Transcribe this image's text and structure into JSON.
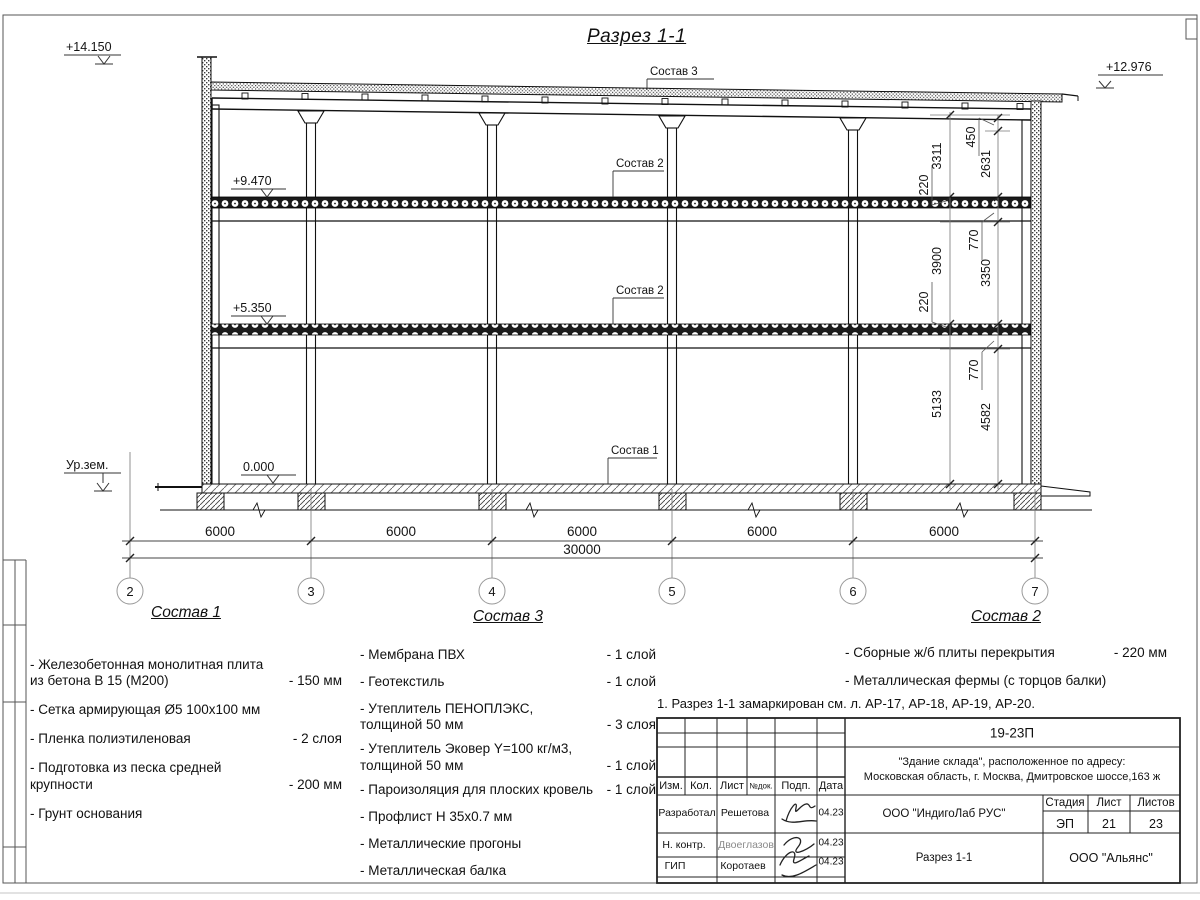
{
  "sheet": {
    "title": "Разрез 1-1",
    "note": "1. Разрез 1-1 замаркирован см. л. АР-17, АР-18, АР-19, АР-20."
  },
  "drawing": {
    "elevations": {
      "roof_left": "+14.150",
      "roof_right": "+12.976",
      "level2": "+9.470",
      "level1": "+5.350",
      "zero": "0.000",
      "ground": "Ур.зем."
    },
    "axes": [
      "2",
      "3",
      "4",
      "5",
      "6",
      "7"
    ],
    "spans": [
      "6000",
      "6000",
      "6000",
      "6000",
      "6000"
    ],
    "total": "30000",
    "vdims": {
      "d3311": "3311",
      "d3900": "3900",
      "d5133": "5133",
      "d2631": "2631",
      "d3350": "3350",
      "d4582": "4582",
      "d450": "450",
      "d770a": "770",
      "d770b": "770",
      "d220a": "220",
      "d220b": "220"
    },
    "labels": {
      "sostav3": "Состав 3",
      "sostav2a": "Состав 2",
      "sostav2b": "Состав 2",
      "sostav1": "Состав 1"
    }
  },
  "lists": {
    "sostav1": {
      "title": "Состав 1",
      "items": [
        {
          "name": "- Железобетонная  монолитная плита из бетона В 15 (М200)",
          "value": "- 150 мм"
        },
        {
          "name": "- Сетка армирующая Ø5 100x100 мм",
          "value": ""
        },
        {
          "name": "- Пленка полиэтиленовая",
          "value": "- 2 слоя"
        },
        {
          "name": "- Подготовка из песка средней крупности",
          "value": "- 200 мм"
        },
        {
          "name": "- Грунт основания",
          "value": ""
        }
      ]
    },
    "sostav3": {
      "title": "Состав 3",
      "items": [
        {
          "name": "- Мембрана ПВХ",
          "value": "- 1 слой"
        },
        {
          "name": "- Геотекстиль",
          "value": "- 1 слой"
        },
        {
          "name": "- Утеплитель ПЕНОПЛЭКС, толщиной 50 мм",
          "value": "- 3 слоя"
        },
        {
          "name": "- Утеплитель Эковер Y=100 кг/м3, толщиной 50 мм",
          "value": "- 1 слой"
        },
        {
          "name": "- Пароизоляция для плоских кровель",
          "value": "- 1 слой"
        },
        {
          "name": "- Профлист Н 35х0.7 мм",
          "value": ""
        },
        {
          "name": "- Металлические прогоны",
          "value": ""
        },
        {
          "name": "- Металлическая балка",
          "value": ""
        }
      ]
    },
    "sostav2": {
      "title": "Состав 2",
      "items": [
        {
          "name": "- Сборные ж/б плиты перекрытия",
          "value": "- 220 мм"
        },
        {
          "name": "- Металлическая фермы (с торцов балки)",
          "value": ""
        }
      ]
    }
  },
  "titleblock": {
    "doc_number": "19-23П",
    "project_line1": "\"Здание склада\", расположенное по адресу:",
    "project_line2": "Московская область, г. Москва, Дмитровское шоссе,163 ж",
    "columns": {
      "izm": "Изм.",
      "kol": "Кол.",
      "list": "Лист",
      "ndok": "№док.",
      "podp": "Подп.",
      "data": "Дата"
    },
    "rows": [
      {
        "role": "Разработал",
        "name": "Решетова",
        "date": "04.23"
      },
      {
        "role": "Н. контр.",
        "name": "Двоеглазов",
        "date": "04.23"
      },
      {
        "role": "ГИП",
        "name": "Коротаев",
        "date": "04.23"
      }
    ],
    "org": "ООО \"ИндигоЛаб РУС\"",
    "stage_label": "Стадия",
    "sheet_label": "Лист",
    "sheets_label": "Листов",
    "stage": "ЭП",
    "sheet_no": "21",
    "sheets_total": "23",
    "drawing_name": "Разрез 1-1",
    "contractor": "ООО \"Альянс\""
  }
}
